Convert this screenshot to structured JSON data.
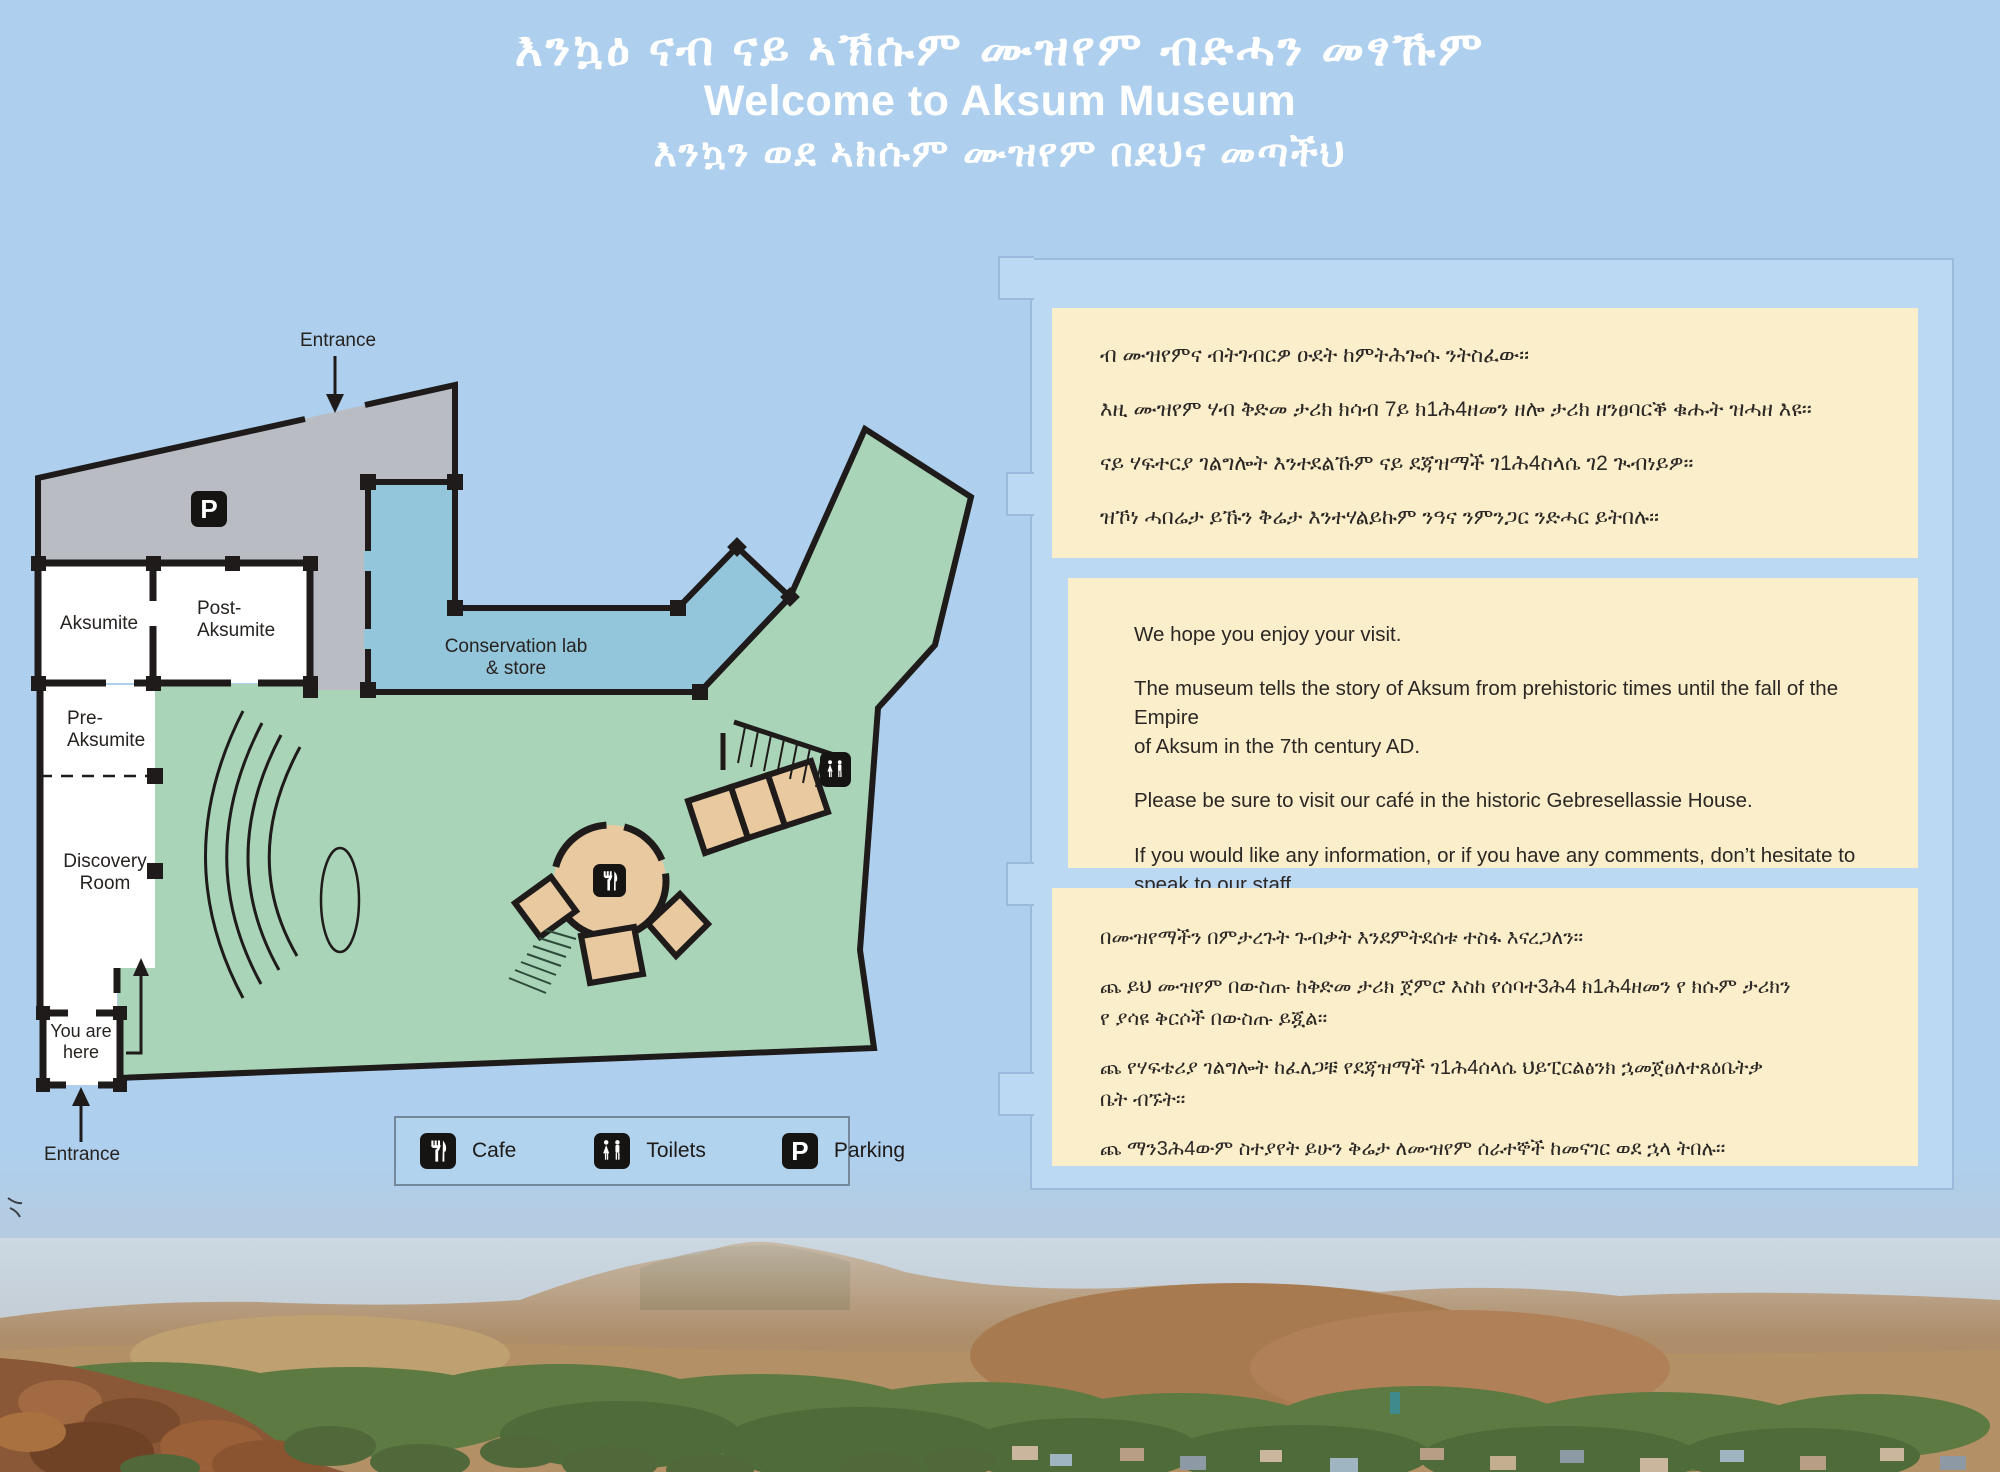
{
  "title": {
    "line_tigrinya": "እንኳዕ ናብ ናይ  ኣኽሱም ሙዝየም ብድሓን መፃኹም",
    "line_english": "Welcome to Aksum Museum",
    "line_amharic": "እንኳን ወደ  ኣክሱም ሙዝየም በደህና መጣችህ"
  },
  "map": {
    "labels": {
      "entrance_top": "Entrance",
      "entrance_bottom": "Entrance",
      "aksumite": "Aksumite",
      "post_aksumite": "Post-\nAksumite",
      "pre_aksumite": "Pre-\nAksumite",
      "discovery_room": "Discovery\nRoom",
      "conservation_lab": "Conservation lab\n& store",
      "you_are_here": "You are\nhere",
      "parking_glyph": "P"
    },
    "icons": [
      "parking-icon",
      "cafe-icon",
      "toilets-icon"
    ]
  },
  "legend": {
    "items": [
      {
        "icon": "cafe-icon",
        "label": "Cafe"
      },
      {
        "icon": "toilets-icon",
        "label": "Toilets"
      },
      {
        "icon": "parking-icon",
        "label": "Parking",
        "glyph": "P"
      }
    ]
  },
  "panels": {
    "tigrinya": {
      "line1": "ብ ሙዝየምና ብትገብርዎ ዑደት ከምትሕጐሱ ንትስፈው፡፡",
      "line2": "እዚ ሙዝየም ሃብ ቅድመ ታሪክ ክሳብ 7ይ ክ1ሕ4ዘመን ዘሎ ታሪክ ዘንፀባርቕ ቁሑት ዝሓዘ እዩ፡፡",
      "line3": "ናይ ሃፍተርያ  ገልግሎት እንተደልኹም ናይ ደጃዝማች ገ1ሕ4ስላሴ ገ2 ጒብነይዎ፡፡",
      "line4": "ዝኾነ ሓበሬታ ይኹን ቅሬታ እንተሃልይኩም ንዓና ንምንጋር ንድሓር  ይትበሉ፡፡"
    },
    "english": {
      "p1": "We hope you enjoy your visit.",
      "p2": "The museum tells the story of Aksum from prehistoric times until the fall of the Empire\nof Aksum in the 7th century AD.",
      "p3": "Please be sure to visit our café in the historic Gebresellassie House.",
      "p4": "If you would like any information, or if you have any comments, don’t hesitate to\nspeak to our staff."
    },
    "amharic": {
      "line1": "በሙዝየማችን በምታረጉት ጉብቃት እንደምትደሰቱ ተስፋ እናረጋለን፡፡",
      "line2": "ጨ ይህ ሙዝየም በውስጡ ከቅድመ ታሪክ ጀምሮ እስከ የሰባተ3ሕ4 ክ1ሕ4ዘመን የ ክሱም ታሪክን\nየ ያሳዩ ቅርሶች በውስጡ ይጇል፡፡",
      "line3": "ጨ የሃፍቴሪያ  ገልግሎት ከፈለጋቹ የደጃዝማች ገ1ሕ4ሰላሴ  ህይፒርልፅንክ ኋመጀፀለተጸዕቤትቃ\nቤት  ብኙት፡፡",
      "line4": "ጨ ማን3ሕ4ውም  ስተያየት ይሁን ቅሬታ ለሙዝየም ሰራተኞች ከመናገር ወደ ኋላ  ትበሉ፡፡"
    }
  },
  "colors": {
    "background": "#aed0ee",
    "board": "#bcd9f4",
    "panel_cream": "#fbeecb",
    "map_gray": "#b9bdc3",
    "map_green": "#a9d4b8",
    "map_lab_blue": "#93c6db",
    "map_tan": "#e9c9a0",
    "wall_black": "#1e1b1a",
    "title_white": "#ffffff"
  }
}
